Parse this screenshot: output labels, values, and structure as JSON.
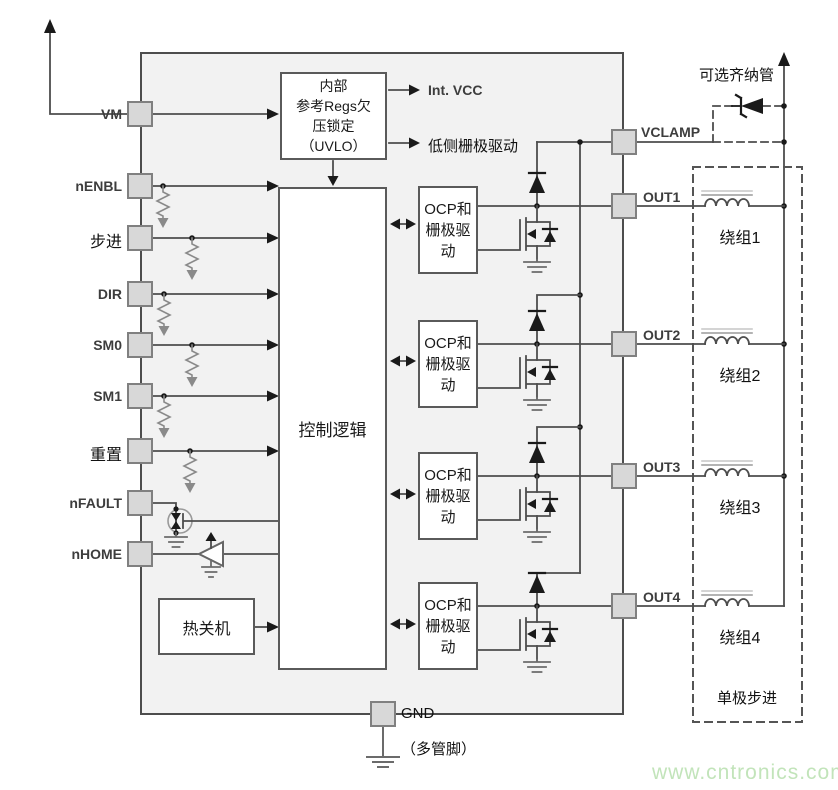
{
  "pins": {
    "left": [
      {
        "id": "vm",
        "label": "VM"
      },
      {
        "id": "nenbl",
        "label": "nENBL"
      },
      {
        "id": "step",
        "label": "步进"
      },
      {
        "id": "dir",
        "label": "DIR"
      },
      {
        "id": "sm0",
        "label": "SM0"
      },
      {
        "id": "sm1",
        "label": "SM1"
      },
      {
        "id": "reset",
        "label": "重置"
      },
      {
        "id": "nfault",
        "label": "nFAULT"
      },
      {
        "id": "nhome",
        "label": "nHOME"
      }
    ],
    "right": [
      {
        "id": "vclamp",
        "label": "VCLAMP"
      },
      {
        "id": "out1",
        "label": "OUT1"
      },
      {
        "id": "out2",
        "label": "OUT2"
      },
      {
        "id": "out3",
        "label": "OUT3"
      },
      {
        "id": "out4",
        "label": "OUT4"
      }
    ],
    "bottom": {
      "label": "GND",
      "note": "（多管脚）"
    }
  },
  "blocks": {
    "uvlo": {
      "line1": "内部",
      "line2": "参考Regs欠",
      "line3": "压锁定",
      "line4": "（UVLO）"
    },
    "control": {
      "label": "控制逻辑"
    },
    "thermal": {
      "label": "热关机"
    },
    "ocp": {
      "line1": "OCP和",
      "line2": "栅极驱",
      "line3": "动"
    }
  },
  "signals": {
    "int_vcc": "Int. VCC",
    "low_side_gate": "低侧栅极驱动"
  },
  "zener": {
    "label": "可选齐纳管"
  },
  "motor": {
    "windings": [
      "绕组1",
      "绕组2",
      "绕组3",
      "绕组4"
    ],
    "caption": "单极步进"
  },
  "watermark": "www.cntronics.com",
  "colors": {
    "chip_fill": "#f2f2f2",
    "line": "#4d4d4d",
    "pin_fill": "#d8d8d8",
    "watermark_green": "#c2e4ba"
  }
}
